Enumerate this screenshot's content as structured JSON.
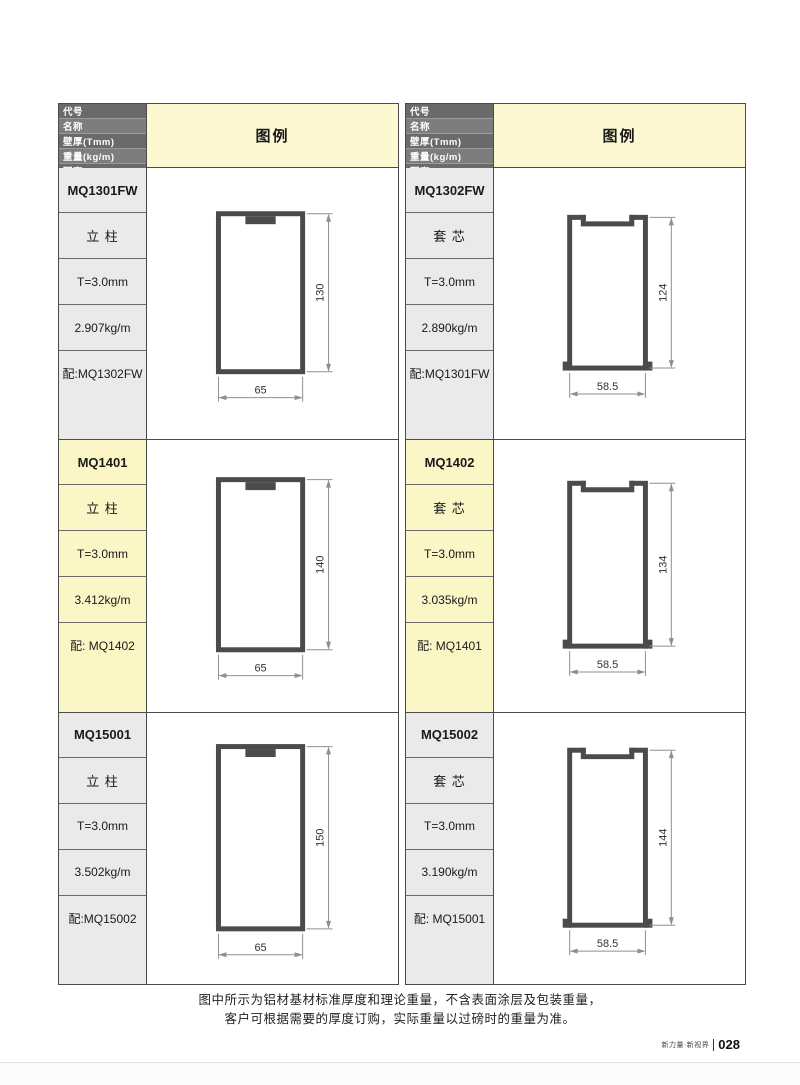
{
  "table_header": {
    "rows": [
      "代号",
      "名称",
      "壁厚(Tmm)",
      "重量(kg/m)",
      "配套"
    ],
    "legend_label": "图例"
  },
  "colors": {
    "header_bg": "#6A6A6A",
    "header_bg_alt": "#7D7D7D",
    "legend_bg": "#FCF9D2",
    "row_gray": "#EAEAEA",
    "row_yellow": "#FAF6C6",
    "profile_stroke": "#4B4B49",
    "dim_line": "#8f8f8f",
    "dim_text": "#333333"
  },
  "profiles": [
    {
      "code": "MQ1301FW",
      "name": "立 柱",
      "thickness": "T=3.0mm",
      "weight": "2.907kg/m",
      "match": "配:MQ1302FW",
      "shape": "column",
      "width_label": "65",
      "height_label": "130",
      "tint": "gray"
    },
    {
      "code": "MQ1302FW",
      "name": "套 芯",
      "thickness": "T=3.0mm",
      "weight": "2.890kg/m",
      "match": "配:MQ1301FW",
      "shape": "core",
      "width_label": "58.5",
      "height_label": "124",
      "tint": "gray"
    },
    {
      "code": "MQ1401",
      "name": "立 柱",
      "thickness": "T=3.0mm",
      "weight": "3.412kg/m",
      "match": "配: MQ1402",
      "shape": "column",
      "width_label": "65",
      "height_label": "140",
      "tint": "yellow"
    },
    {
      "code": "MQ1402",
      "name": "套 芯",
      "thickness": "T=3.0mm",
      "weight": "3.035kg/m",
      "match": "配: MQ1401",
      "shape": "core",
      "width_label": "58.5",
      "height_label": "134",
      "tint": "yellow"
    },
    {
      "code": "MQ15001",
      "name": "立 柱",
      "thickness": "T=3.0mm",
      "weight": "3.502kg/m",
      "match": "配:MQ15002",
      "shape": "column",
      "width_label": "65",
      "height_label": "150",
      "tint": "gray"
    },
    {
      "code": "MQ15002",
      "name": "套 芯",
      "thickness": "T=3.0mm",
      "weight": "3.190kg/m",
      "match": "配: MQ15001",
      "shape": "core",
      "width_label": "58.5",
      "height_label": "144",
      "tint": "gray"
    }
  ],
  "footer_note": {
    "line1": "图中所示为铝材基材标准厚度和理论重量，不含表面涂层及包装重量，",
    "line2": "客户可根据需要的厚度订购，实际重量以过磅时的重量为准。"
  },
  "page_footer": {
    "tagline": "新力量·新视界",
    "page_number": "028"
  }
}
